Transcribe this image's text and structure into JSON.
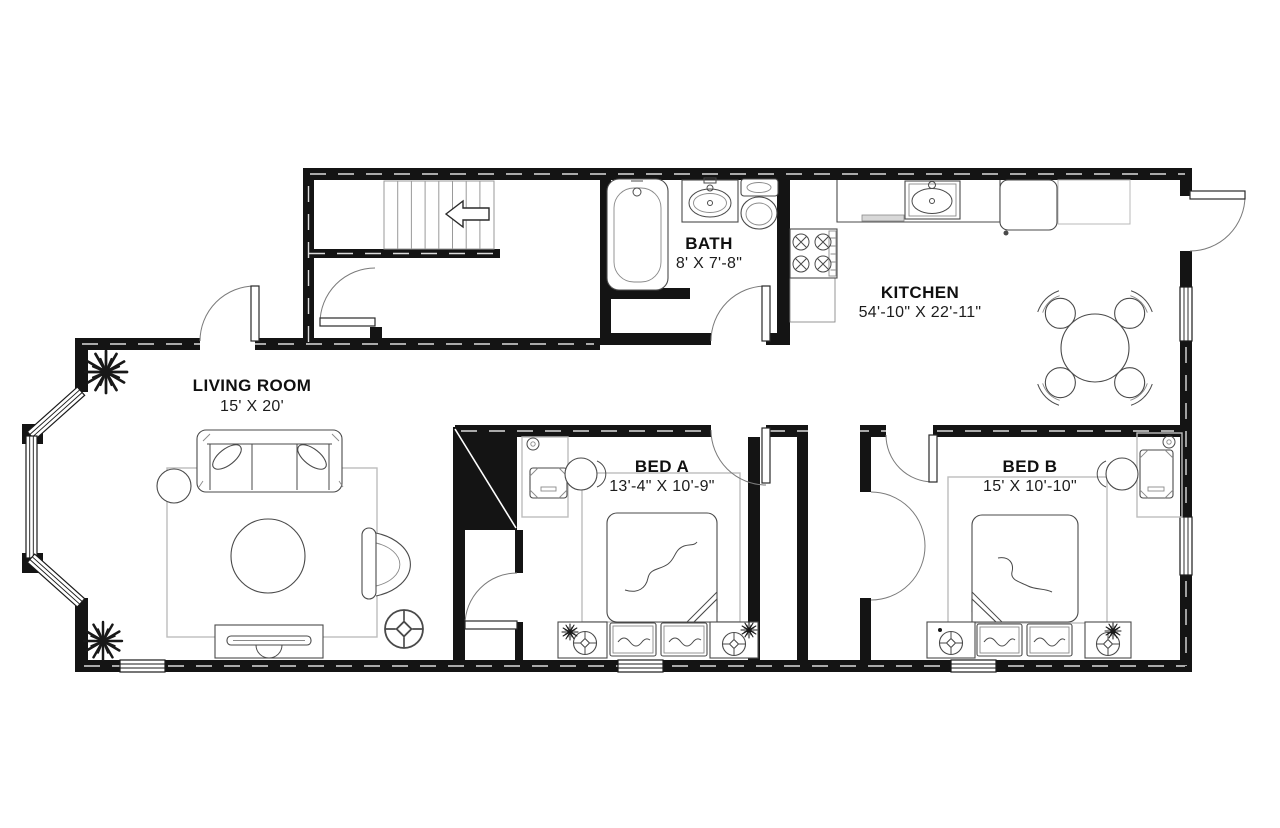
{
  "colors": {
    "wall": "#141414",
    "furniture_stroke": "#4a4a4a",
    "rug_stroke": "#bdbdbd",
    "background": "#ffffff"
  },
  "rooms": [
    {
      "id": "living-room",
      "name": "LIVING ROOM",
      "dims": "15' X 20'"
    },
    {
      "id": "bath",
      "name": "BATH",
      "dims": "8' X 7'-8\""
    },
    {
      "id": "kitchen",
      "name": "KITCHEN",
      "dims": "54'-10\" X 22'-11\""
    },
    {
      "id": "bed-a",
      "name": "BED A",
      "dims": "13'-4\" X 10'-9\""
    },
    {
      "id": "bed-b",
      "name": "BED B",
      "dims": "15' X 10'-10\""
    }
  ]
}
